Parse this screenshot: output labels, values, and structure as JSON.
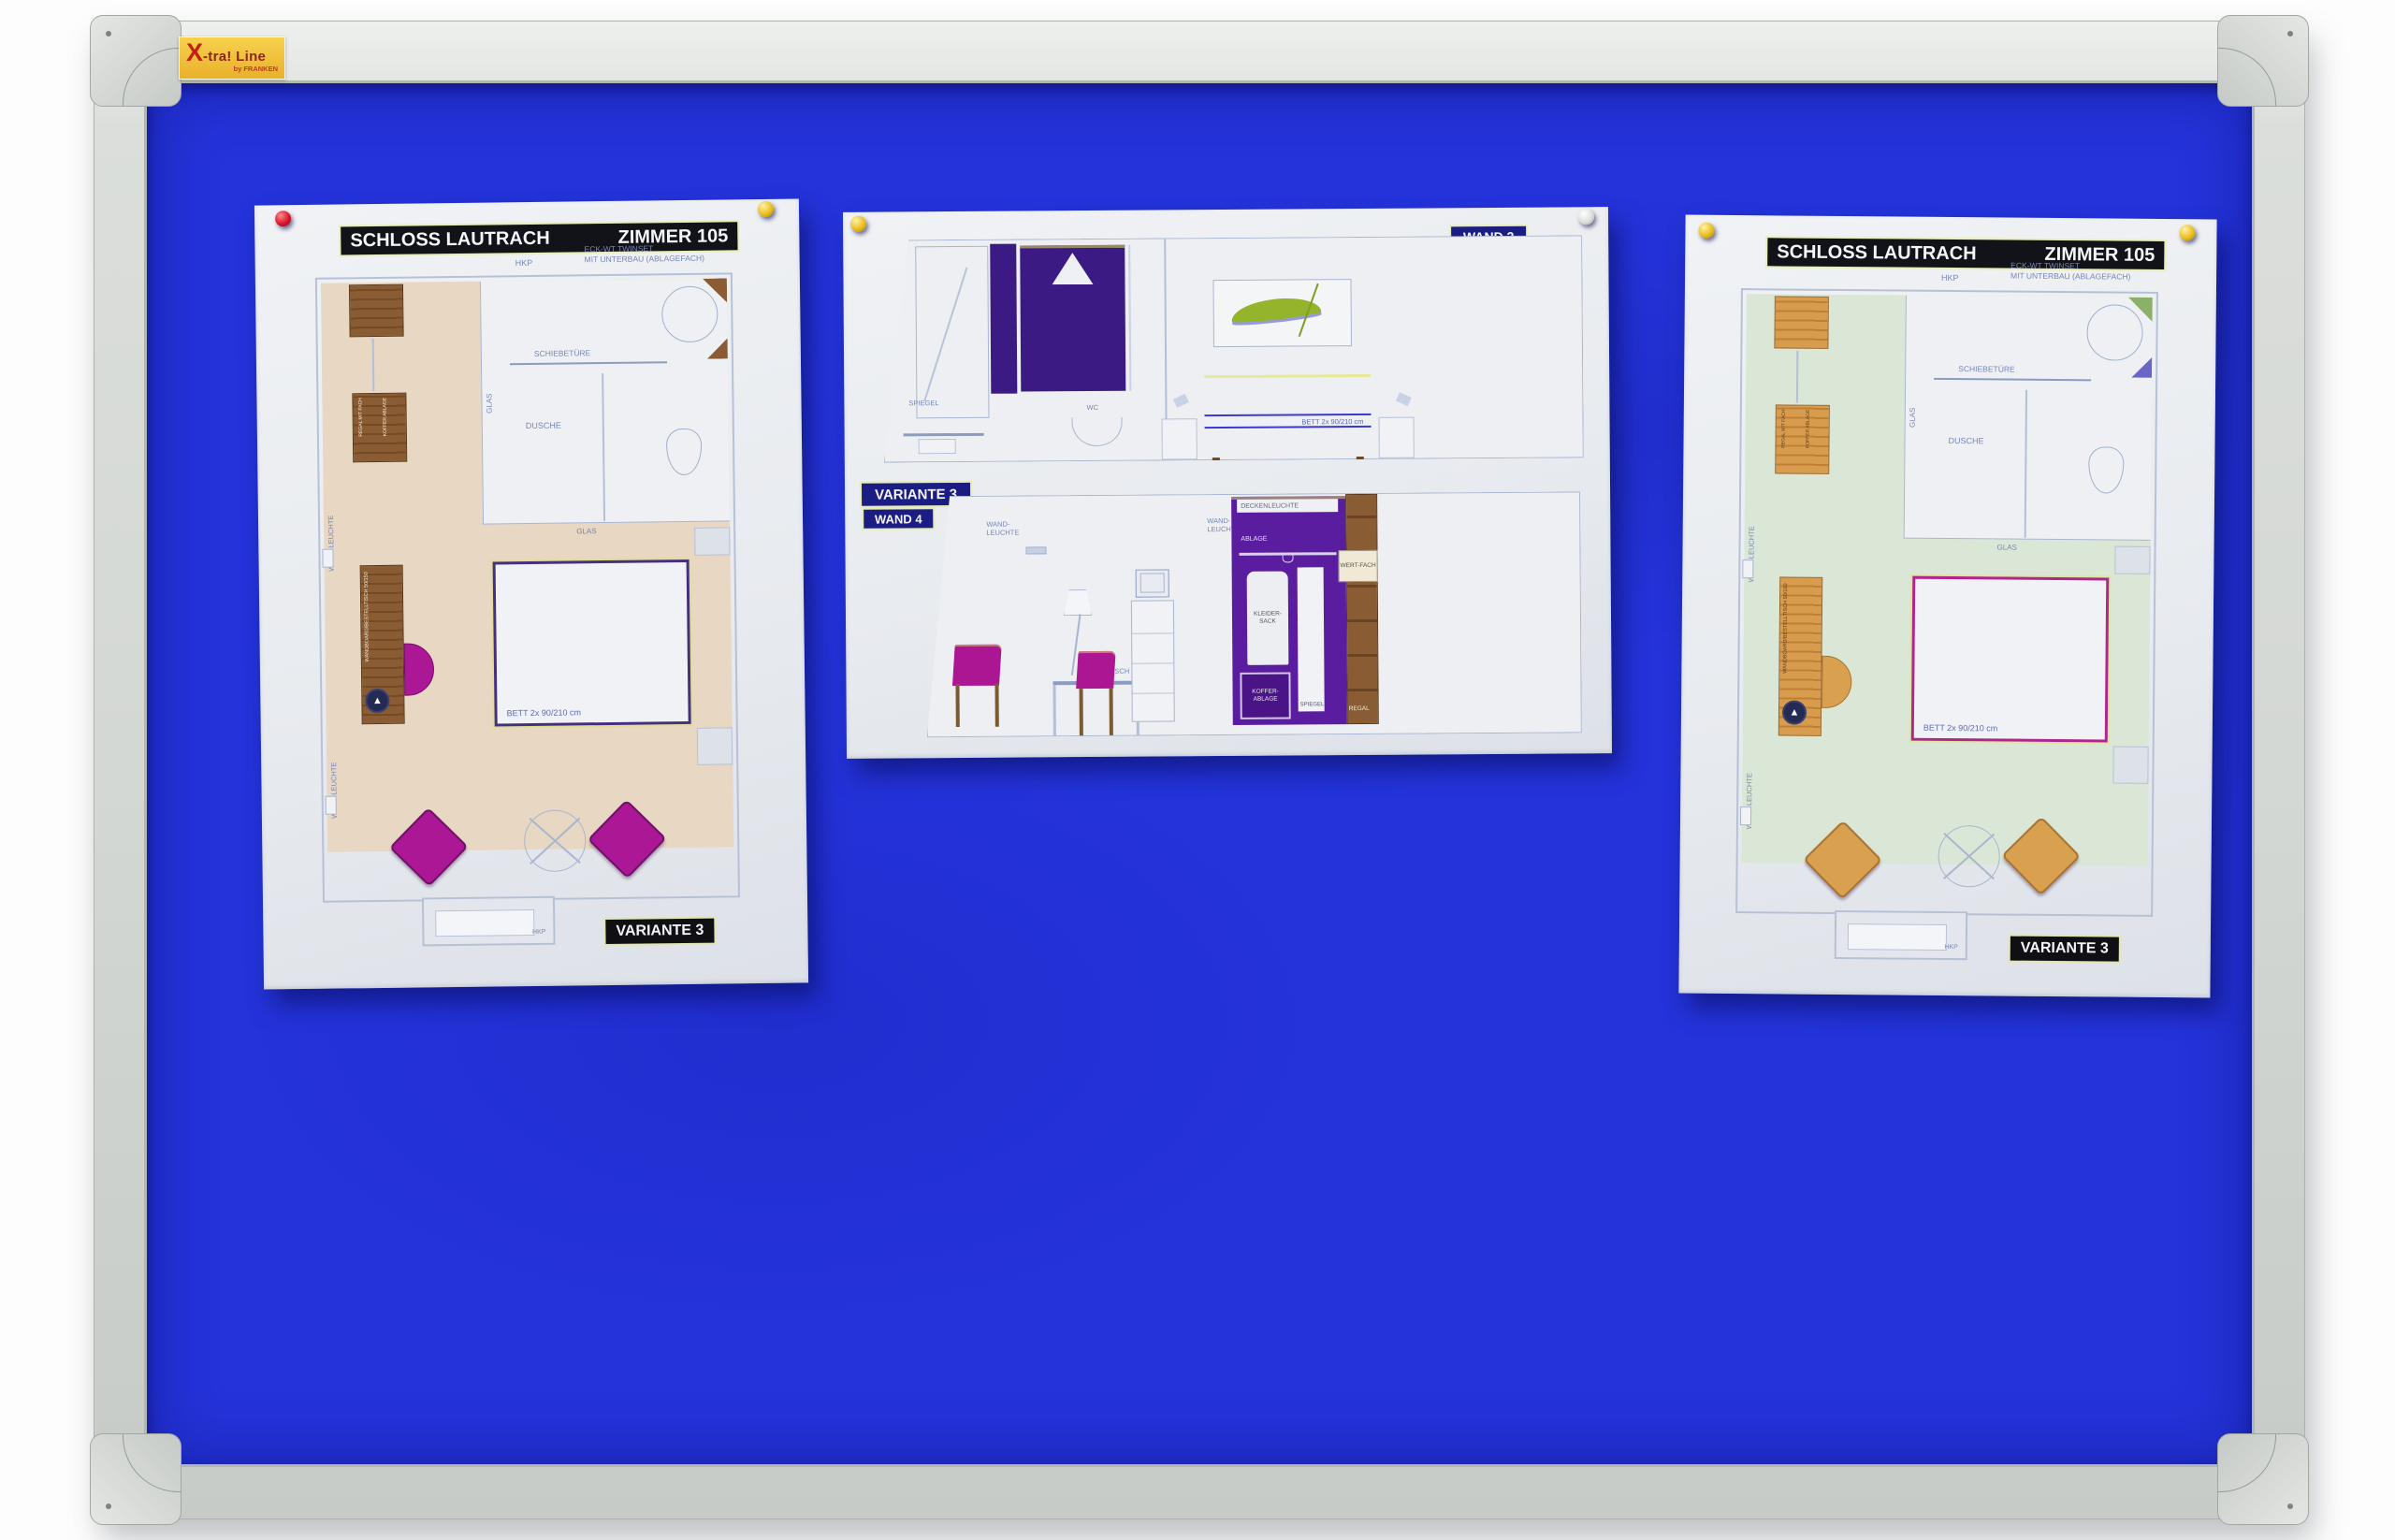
{
  "scene": {
    "description": "Blue felt pin board with aluminium frame holding three pinned hotel-room plan sheets",
    "sticker": {
      "brand_x": "X",
      "brand_rest": "-tra! Line",
      "byline": "by FRANKEN"
    }
  },
  "colors": {
    "felt_blue": "#2433DA",
    "frame_gray": "#D4D8D4",
    "paper_white": "#EAEDF1",
    "floor_beige": "#E7D7C3",
    "floor_mint": "#DAE7D7",
    "magenta": "#AC1795",
    "purple": "#5A1DA0",
    "dark_purple": "#3C1A84",
    "wood_brown": "#8A5C33",
    "wood_tan": "#D89C4F",
    "sticker_yellow": "#F0C23C",
    "sticker_red": "#C61F10"
  },
  "icons": {
    "compass": "▲"
  },
  "papers": {
    "left": {
      "title": "SCHLOSS LAUTRACH",
      "room": "ZIMMER 105",
      "variant": "VARIANTE 3",
      "top_notes": {
        "hkp": "HKP",
        "line1": "ECK-WT TWINSET",
        "line2": "MIT UNTERBAU (ABLAGEFACH)"
      },
      "labels": {
        "schiebetuere": "SCHIEBETÜRE",
        "dusche": "DUSCHE",
        "glas_side": "GLAS",
        "glas_bottom": "GLAS",
        "wandleuchte_upper": "WAND-LEUCHTE",
        "wandleuchte_lower": "WAND-LEUCHTE",
        "bett": "BETT 2x 90/210 cm",
        "hkp_window": "HKP",
        "regal": "REGAL MIT FACH",
        "koffer": "KOFFER ABLAGE",
        "desk": "WANDBOARD/BESTELLTISCH 50/150"
      },
      "pins": [
        "red-pushpin",
        "yellow-pushpin"
      ]
    },
    "middle": {
      "wand2": "WAND 2",
      "variant": "VARIANTE 3",
      "wand4": "WAND 4",
      "labels": {
        "spiegel_bath": "SPIEGEL",
        "ablage_bath": "ABLAGE",
        "wc": "WC",
        "bett": "BETT 2x 90/210 cm",
        "wandleuchte_a": "WAND-LEUCHTE",
        "wandleuchte_b": "WAND-LEUCHTE",
        "schreibtisch": "SCHREIBTISCH",
        "deckenleuchte": "DECKENLEUCHTE",
        "ablage_top": "ABLAGE",
        "kleidersack": "KLEIDER-SACK",
        "koffer": "KOFFER-ABLAGE",
        "spiegel_wardrobe": "SPIEGEL",
        "wertfach": "WERT-FACH",
        "regal": "REGAL"
      },
      "pins": [
        "yellow-pushpin",
        "silver-pushpin"
      ]
    },
    "right": {
      "title": "SCHLOSS LAUTRACH",
      "room": "ZIMMER 105",
      "variant": "VARIANTE 3",
      "top_notes": {
        "hkp": "HKP",
        "line1": "ECK-WT TWINSET",
        "line2": "MIT UNTERBAU (ABLAGEFACH)"
      },
      "labels": {
        "schiebetuere": "SCHIEBETÜRE",
        "dusche": "DUSCHE",
        "glas_side": "GLAS",
        "glas_bottom": "GLAS",
        "wandleuchte_upper": "WAND-LEUCHTE",
        "wandleuchte_lower": "WAND-LEUCHTE",
        "bett": "BETT 2x 90/210 cm",
        "hkp_window": "HKP",
        "regal": "REGAL MIT FACH",
        "koffer": "KOFFER ABLAGE",
        "desk": "WANDBOARD/BESTELLTISCH 50/150"
      },
      "pins": [
        "yellow-pushpin",
        "yellow-pushpin"
      ]
    }
  }
}
